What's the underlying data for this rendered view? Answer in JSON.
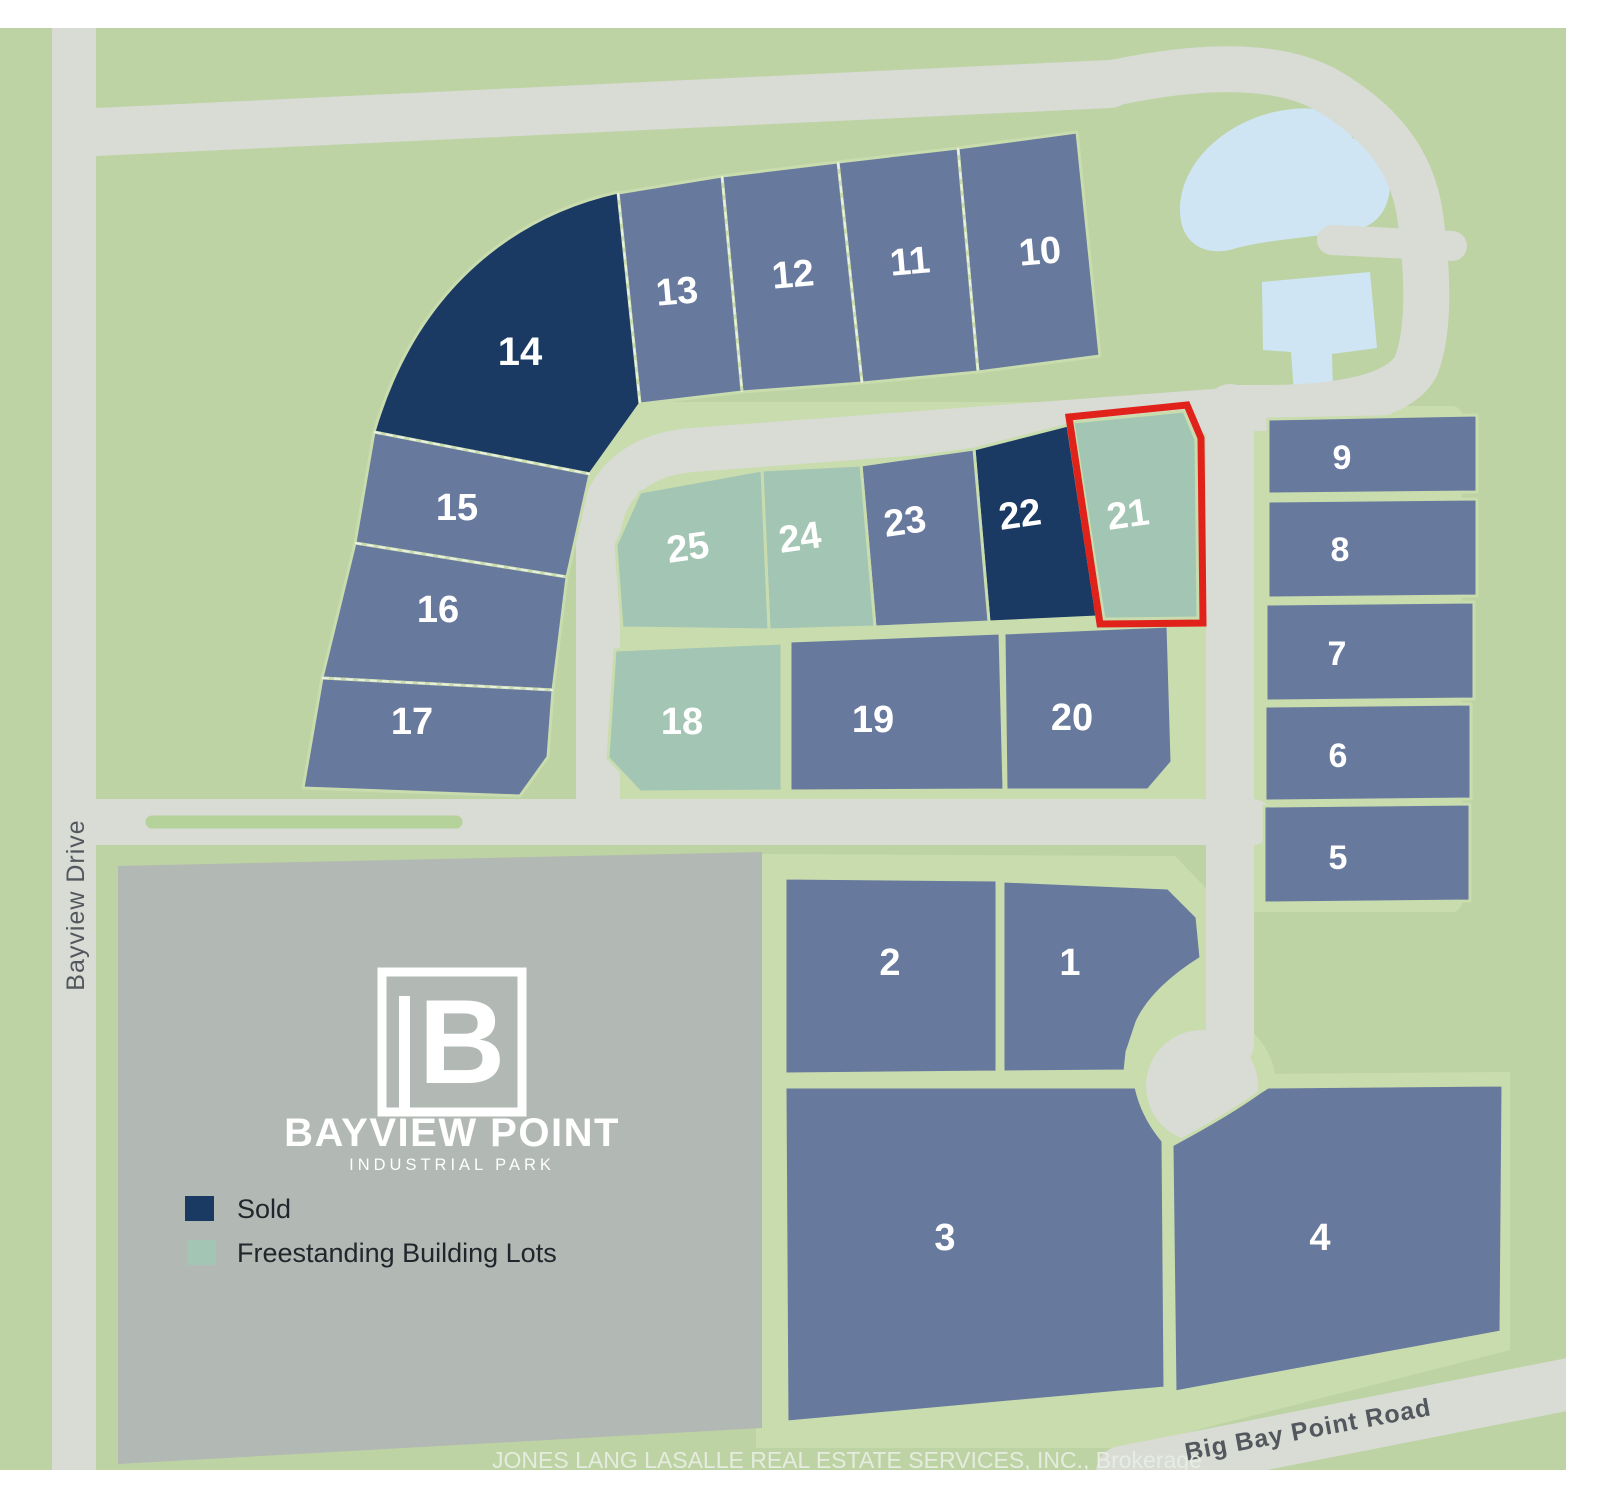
{
  "map": {
    "colors": {
      "land_green": "#bdd3a4",
      "pad_green": "#c9dcae",
      "road_gray": "#d9dbd5",
      "median_green": "#b5d29a",
      "lot_available": "#68799e",
      "lot_sold": "#1a3a63",
      "lot_freestanding": "#a3c5b4",
      "pond_blue": "#cfe5f4",
      "parcel_gray": "#b2b8b3",
      "highlight_red": "#e0221a"
    },
    "logo": {
      "monogram": "B",
      "title": "BAYVIEW POINT",
      "subtitle": "INDUSTRIAL PARK"
    },
    "legend": {
      "items": [
        {
          "label": "Sold",
          "status": "sold"
        },
        {
          "label": "Freestanding Building Lots",
          "status": "freestanding"
        }
      ]
    },
    "roads": [
      {
        "name": "Bayview Drive"
      },
      {
        "name": "Big Bay Point Road"
      }
    ],
    "footer": "JONES LANG LASALLE REAL ESTATE SERVICES, INC., Brokerage",
    "lots": [
      {
        "label": "1",
        "status": "available"
      },
      {
        "label": "2",
        "status": "available"
      },
      {
        "label": "3",
        "status": "available"
      },
      {
        "label": "4",
        "status": "available"
      },
      {
        "label": "5",
        "status": "available"
      },
      {
        "label": "6",
        "status": "available"
      },
      {
        "label": "7",
        "status": "available"
      },
      {
        "label": "8",
        "status": "available"
      },
      {
        "label": "9",
        "status": "available"
      },
      {
        "label": "10",
        "status": "available"
      },
      {
        "label": "11",
        "status": "available"
      },
      {
        "label": "12",
        "status": "available"
      },
      {
        "label": "13",
        "status": "available"
      },
      {
        "label": "14",
        "status": "sold"
      },
      {
        "label": "15",
        "status": "available"
      },
      {
        "label": "16",
        "status": "available"
      },
      {
        "label": "17",
        "status": "available"
      },
      {
        "label": "18",
        "status": "freestanding"
      },
      {
        "label": "19",
        "status": "available"
      },
      {
        "label": "20",
        "status": "available"
      },
      {
        "label": "21",
        "status": "freestanding",
        "highlighted": true
      },
      {
        "label": "22",
        "status": "sold"
      },
      {
        "label": "23",
        "status": "available"
      },
      {
        "label": "24",
        "status": "freestanding"
      },
      {
        "label": "25",
        "status": "freestanding"
      }
    ]
  }
}
